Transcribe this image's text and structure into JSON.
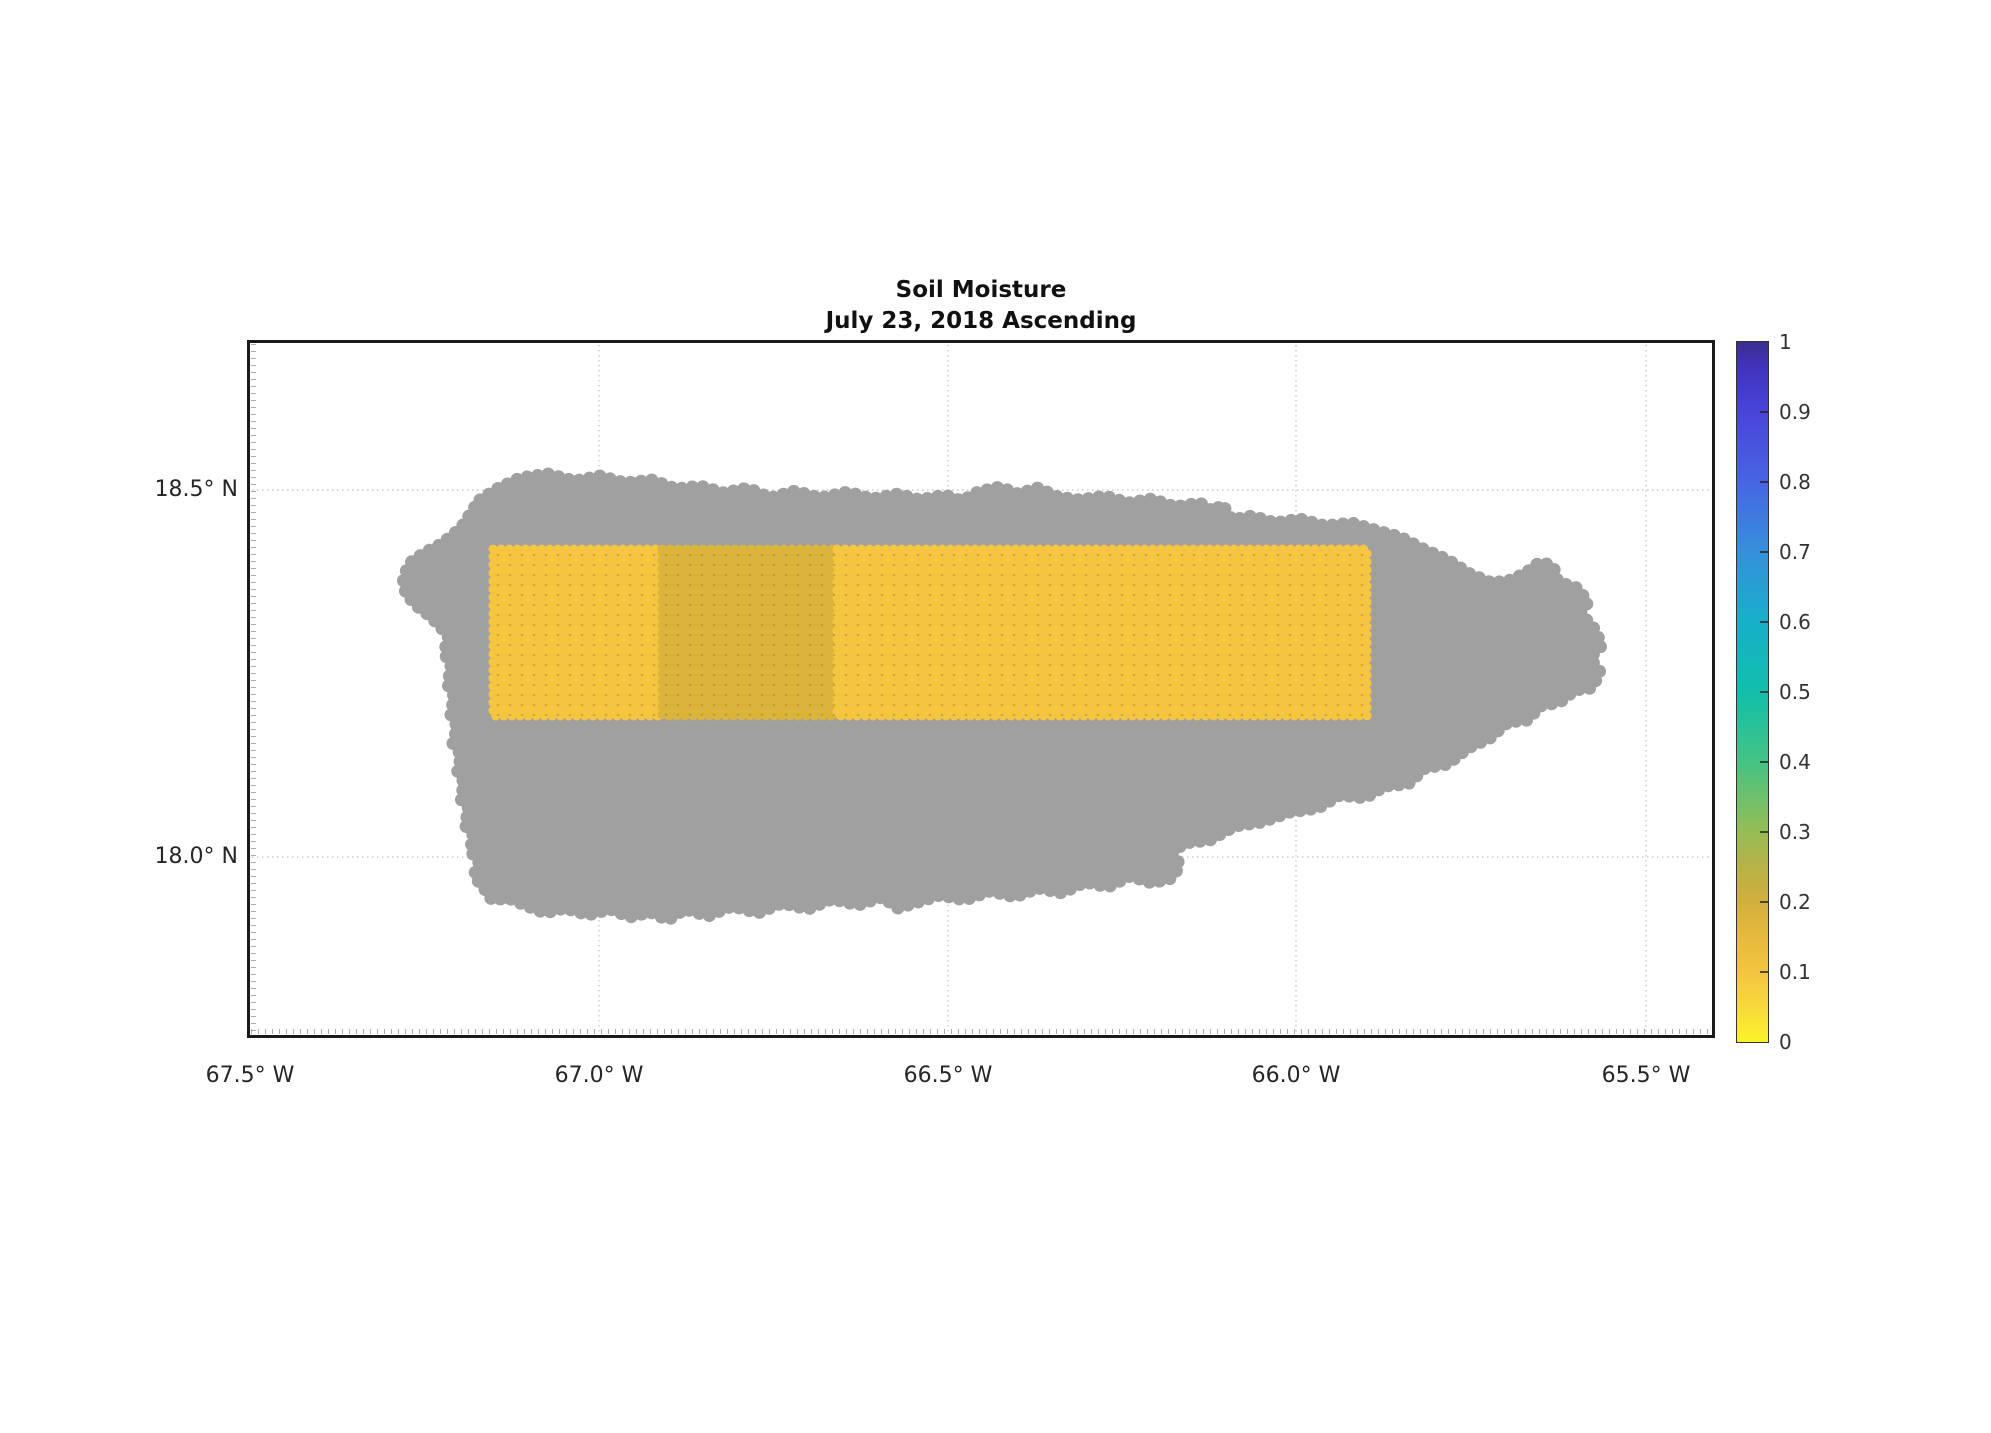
{
  "title": {
    "line1": "Soil Moisture",
    "line2": "July 23, 2018 Ascending"
  },
  "axes": {
    "x_ticks": [
      "67.5° W",
      "67.0° W",
      "66.5° W",
      "66.0° W",
      "65.5° W"
    ],
    "y_ticks": [
      "18.5° N",
      "18.0° N"
    ],
    "grid_color": "#cccccc"
  },
  "colorbar": {
    "min": 0,
    "max": 1,
    "ticks": [
      "1",
      "0.9",
      "0.8",
      "0.7",
      "0.6",
      "0.5",
      "0.4",
      "0.3",
      "0.2",
      "0.1",
      "0"
    ],
    "stops": [
      {
        "value": 1.0,
        "color": "#3B2D90"
      },
      {
        "value": 0.96,
        "color": "#4134BE"
      },
      {
        "value": 0.9,
        "color": "#4A44D9"
      },
      {
        "value": 0.8,
        "color": "#4765E2"
      },
      {
        "value": 0.7,
        "color": "#3590DB"
      },
      {
        "value": 0.6,
        "color": "#18AFC9"
      },
      {
        "value": 0.5,
        "color": "#10BFAB"
      },
      {
        "value": 0.4,
        "color": "#45C384"
      },
      {
        "value": 0.3,
        "color": "#96BD55"
      },
      {
        "value": 0.25,
        "color": "#B7B246"
      },
      {
        "value": 0.2,
        "color": "#D2AF3D"
      },
      {
        "value": 0.15,
        "color": "#E6BA3E"
      },
      {
        "value": 0.1,
        "color": "#F3C53F"
      },
      {
        "value": 0.05,
        "color": "#F8D83B"
      },
      {
        "value": 0.0,
        "color": "#FBF32B"
      }
    ]
  },
  "map": {
    "island_color": "#A0A0A0",
    "swaths": [
      {
        "color": "#F6C53F",
        "value": 0.1
      },
      {
        "color": "#DCB43C",
        "value": 0.18
      },
      {
        "color": "#F6C53F",
        "value": 0.1
      }
    ]
  },
  "chart_data": {
    "type": "heatmap",
    "title": "Soil Moisture",
    "subtitle": "July 23, 2018 Ascending",
    "x_axis": {
      "tick_labels": [
        "67.5° W",
        "67.0° W",
        "66.5° W",
        "66.0° W",
        "65.5° W"
      ],
      "range_deg_west": [
        67.5,
        65.4
      ]
    },
    "y_axis": {
      "tick_labels": [
        "18.5° N",
        "18.0° N"
      ],
      "range_deg_north": [
        17.75,
        18.7
      ]
    },
    "grid": "dotted, light gray, on",
    "legend_position": "colorbar right, vertical, 0 to 1 every 0.1",
    "basemap": "Puerto Rico island mask rendered as gray scatter dots (no-data areas gray)",
    "series": [
      {
        "name": "west swath",
        "lon_west_range": [
          67.15,
          66.91
        ],
        "lat_north_range": [
          18.19,
          18.42
        ],
        "soil_moisture": 0.1
      },
      {
        "name": "central swath",
        "lon_west_range": [
          66.91,
          66.66
        ],
        "lat_north_range": [
          18.19,
          18.42
        ],
        "soil_moisture": 0.18
      },
      {
        "name": "east swath",
        "lon_west_range": [
          66.66,
          65.9
        ],
        "lat_north_range": [
          18.19,
          18.42
        ],
        "soil_moisture": 0.1
      }
    ],
    "colorbar_range": [
      0,
      1
    ]
  }
}
